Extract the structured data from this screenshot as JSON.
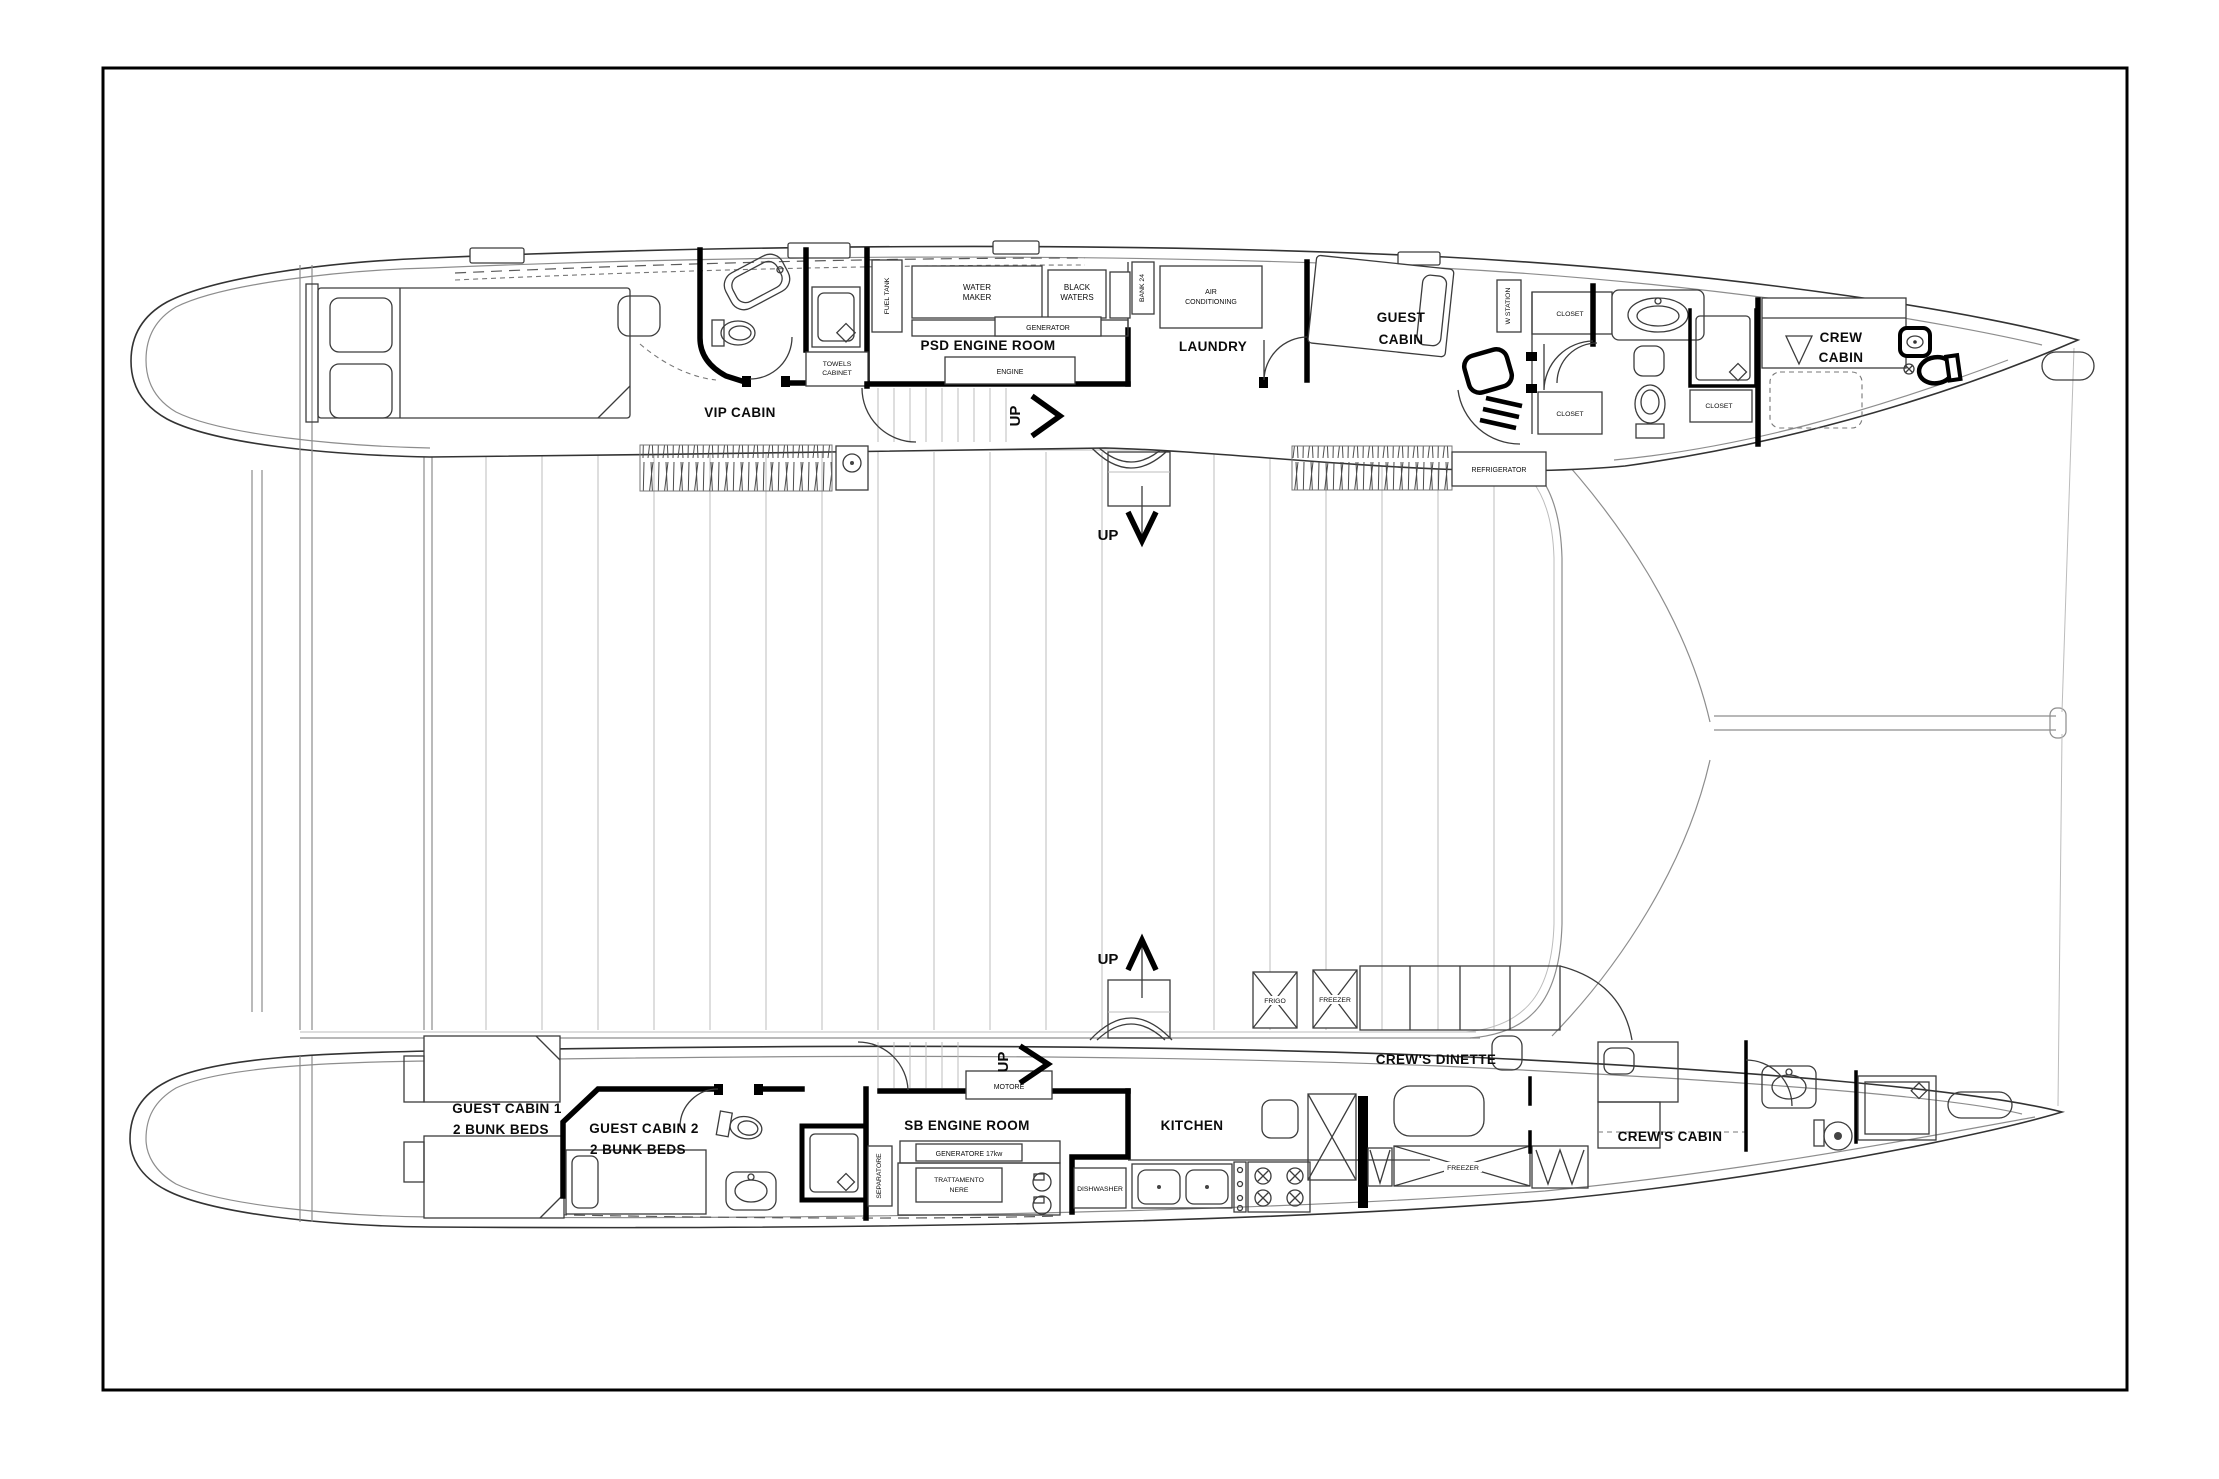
{
  "sheet": {
    "background": "#ffffff",
    "frame_color": "#000000",
    "ink_color": "#2f2f2f"
  },
  "plan": {
    "type": "catamaran lower deck floor plan",
    "rooms": {
      "vip_cabin": "VIP CABIN",
      "psd_engine_room": "PSD ENGINE ROOM",
      "laundry": "LAUNDRY",
      "guest_cabin": [
        "GUEST",
        "CABIN"
      ],
      "crew_cabin": [
        "CREW",
        "CABIN"
      ],
      "guest_cabin_1": [
        "GUEST CABIN 1",
        "2 BUNK BEDS"
      ],
      "guest_cabin_2": [
        "GUEST CABIN 2",
        "2 BUNK BEDS"
      ],
      "sb_engine_room": "SB ENGINE ROOM",
      "kitchen": "KITCHEN",
      "crews_dinette": "CREW'S DINETTE",
      "crews_cabin": "CREW'S CABIN"
    },
    "equipment": {
      "fuel_tank": "FUEL TANK",
      "water_maker": [
        "WATER",
        "MAKER"
      ],
      "black_waters": [
        "BLACK",
        "WATERS"
      ],
      "generator": "GENERATOR",
      "engine": "ENGINE",
      "towels_cabinet": [
        "TOWELS",
        "CABINET"
      ],
      "air_conditioning": [
        "AIR",
        "CONDITIONING"
      ],
      "bank_24": "BANK 24",
      "w_station": "W STATION",
      "closet": "CLOSET",
      "refrigerator": "REFRIGERATOR",
      "separatore": "SEPARATORE",
      "generatore": "GENERATORE 17kw",
      "trattamento": [
        "TRATTAMENTO",
        "NERE"
      ],
      "motore": "MOTORE",
      "dishwasher": "DISHWASHER",
      "frigo": "FRIGO",
      "freezer": "FREEZER",
      "frigo_verdure": [
        "FRIGO",
        "VERDURE"
      ]
    },
    "stairs": {
      "up": "UP"
    }
  }
}
